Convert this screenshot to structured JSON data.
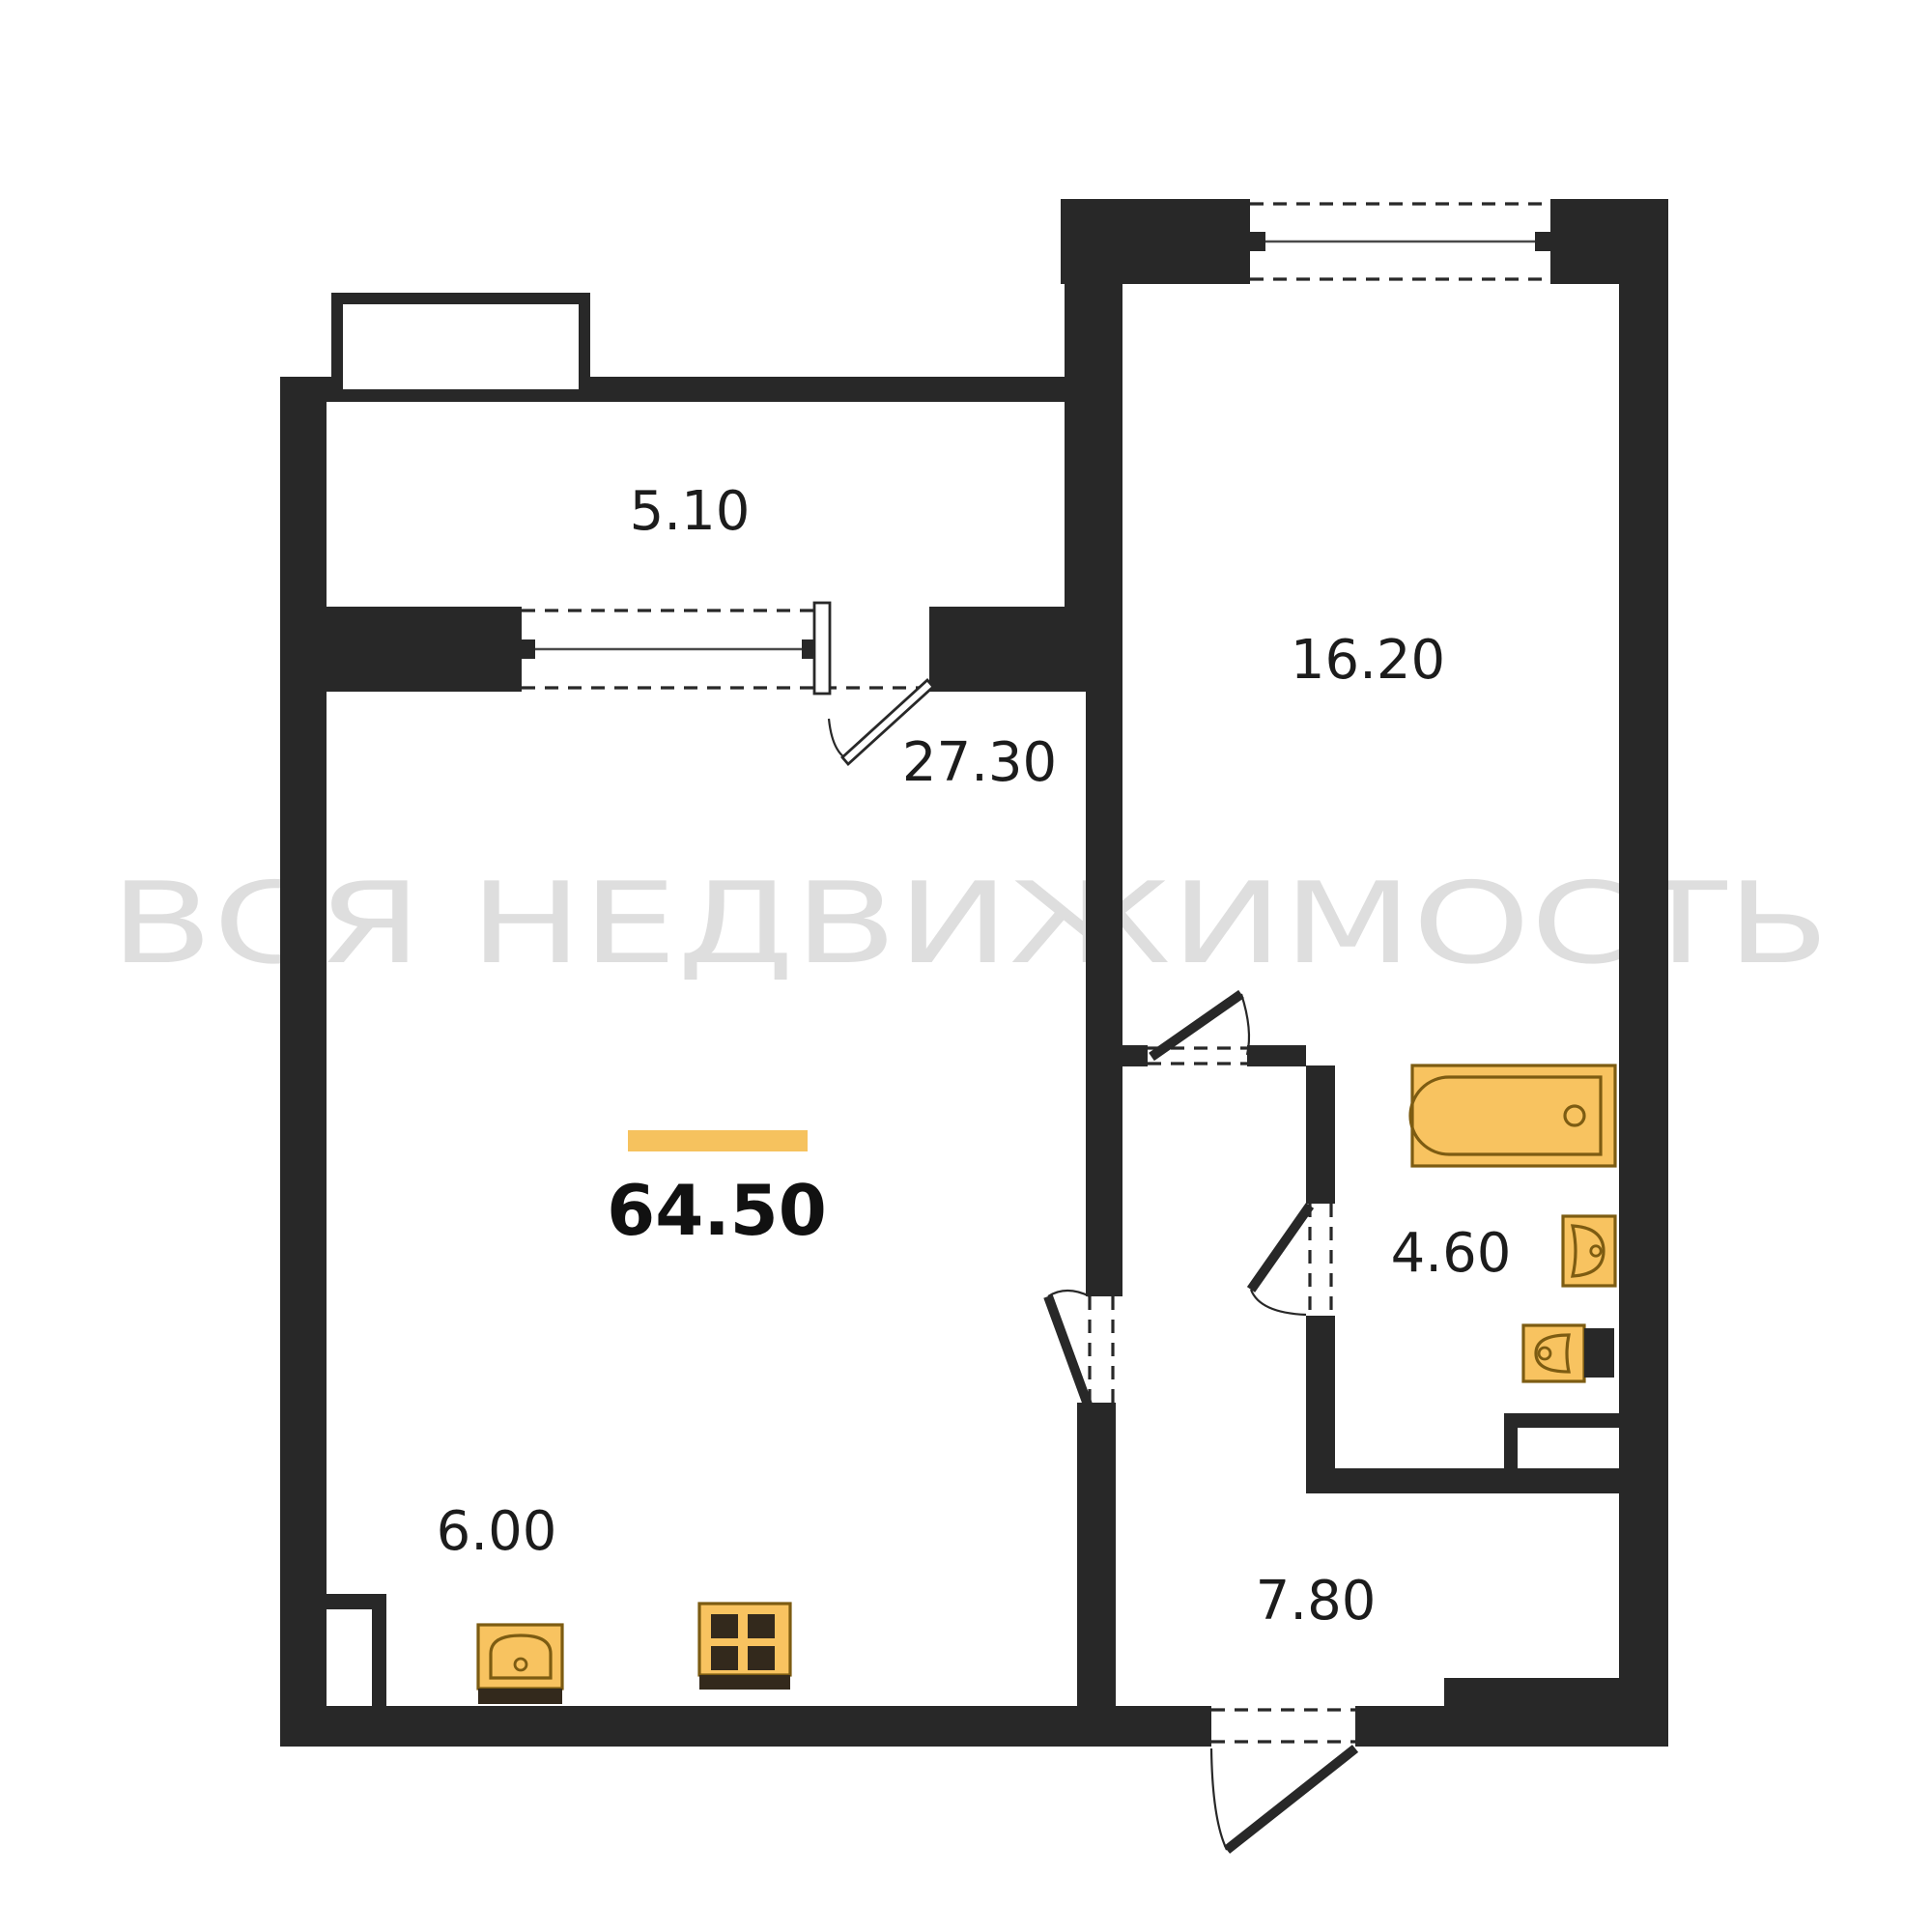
{
  "watermark": {
    "text": "ВСЯ НЕДВИЖИМОСТЬ"
  },
  "total": {
    "area": "64.50"
  },
  "rooms": {
    "balcony": {
      "area": "5.10"
    },
    "living_room": {
      "area": "27.30"
    },
    "bedroom": {
      "area": "16.20"
    },
    "bathroom": {
      "area": "4.60"
    },
    "kitchen": {
      "area": "6.00"
    },
    "hallway": {
      "area": "7.80"
    }
  },
  "fixtures": [
    "bathtub-icon",
    "wash-basin-icon",
    "toilet-icon",
    "kitchen-sink-icon",
    "stove-icon"
  ],
  "colors": {
    "wall": "#282828",
    "fixture_fill": "#f8c360",
    "fixture_stroke": "#7d5c12",
    "accent_bar": "#f6c25e",
    "watermark": "#dedede"
  }
}
